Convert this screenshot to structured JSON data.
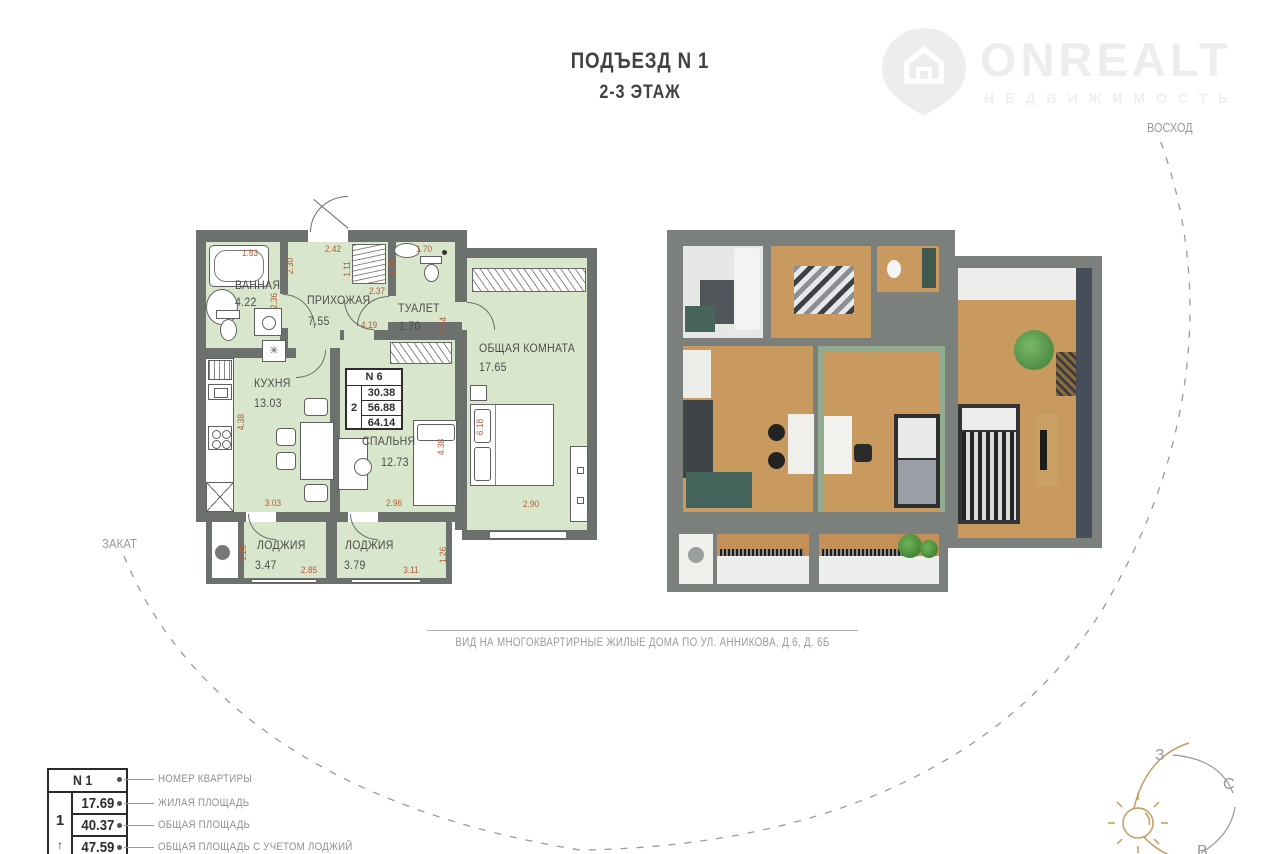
{
  "header": {
    "title_line1": "ПОДЪЕЗД N 1",
    "title_line2": "2-3 ЭТАЖ"
  },
  "brand": {
    "name": "ONREALT",
    "tagline": "НЕДВИЖИМОСТЬ"
  },
  "sun_path": {
    "sunrise_label": "ВОСХОД",
    "sunset_label": "ЗАКАТ"
  },
  "compass": {
    "west": "З",
    "north": "С",
    "east": "В"
  },
  "caption": "ВИД НА МНОГОКВАРТИРНЫЕ ЖИЛЫЕ ДОМА ПО УЛ. АННИКОВА, Д.6, Д. 6Б",
  "plan": {
    "rooms": {
      "bathroom": {
        "name": "ВАННАЯ",
        "area": "4.22"
      },
      "hallway": {
        "name": "ПРИХОЖАЯ",
        "area": "7.55"
      },
      "toilet": {
        "name": "ТУАЛЕТ",
        "area": "1.70"
      },
      "living": {
        "name": "ОБЩАЯ КОМНАТА",
        "area": "17.65"
      },
      "kitchen": {
        "name": "КУХНЯ",
        "area": "13.03"
      },
      "bedroom": {
        "name": "СПАЛЬНЯ",
        "area": "12.73"
      },
      "loggia1": {
        "name": "ЛОДЖИЯ",
        "area": "3.47"
      },
      "loggia2": {
        "name": "ЛОДЖИЯ",
        "area": "3.79"
      }
    },
    "info_box": {
      "apartment_number": "N 6",
      "rooms_count": "2",
      "living_area": "30.38",
      "total_area": "56.88",
      "total_area_with_loggias": "64.14"
    },
    "dims": [
      "1.83",
      "2.42",
      "1.70",
      "2.30",
      "1.11",
      "1.05",
      "2.37",
      "2.36",
      "4.19",
      "1.24",
      "4.38",
      "6.18",
      "4.38",
      "3.03",
      "2.96",
      "2.90",
      "1.26",
      "2.85",
      "3.11",
      "1.26"
    ]
  },
  "legend": {
    "floor": "1",
    "floor_arrow": "↑",
    "rows": [
      {
        "value": "N 1",
        "label": "НОМЕР КВАРТИРЫ"
      },
      {
        "value": "17.69",
        "label": "ЖИЛАЯ ПЛОЩАДЬ"
      },
      {
        "value": "40.37",
        "label": "ОБЩАЯ ПЛОЩАДЬ"
      },
      {
        "value": "47.59",
        "label": "ОБЩАЯ ПЛОЩАДЬ С УЧЕТОМ ЛОДЖИЙ"
      }
    ]
  },
  "colors": {
    "plan_room_fill": "#d8e7cc",
    "plan_wall": "#6d716e",
    "dimension_text": "#b25a36",
    "sun_accent": "#c9995d",
    "muted_text": "#9b9b9b"
  }
}
